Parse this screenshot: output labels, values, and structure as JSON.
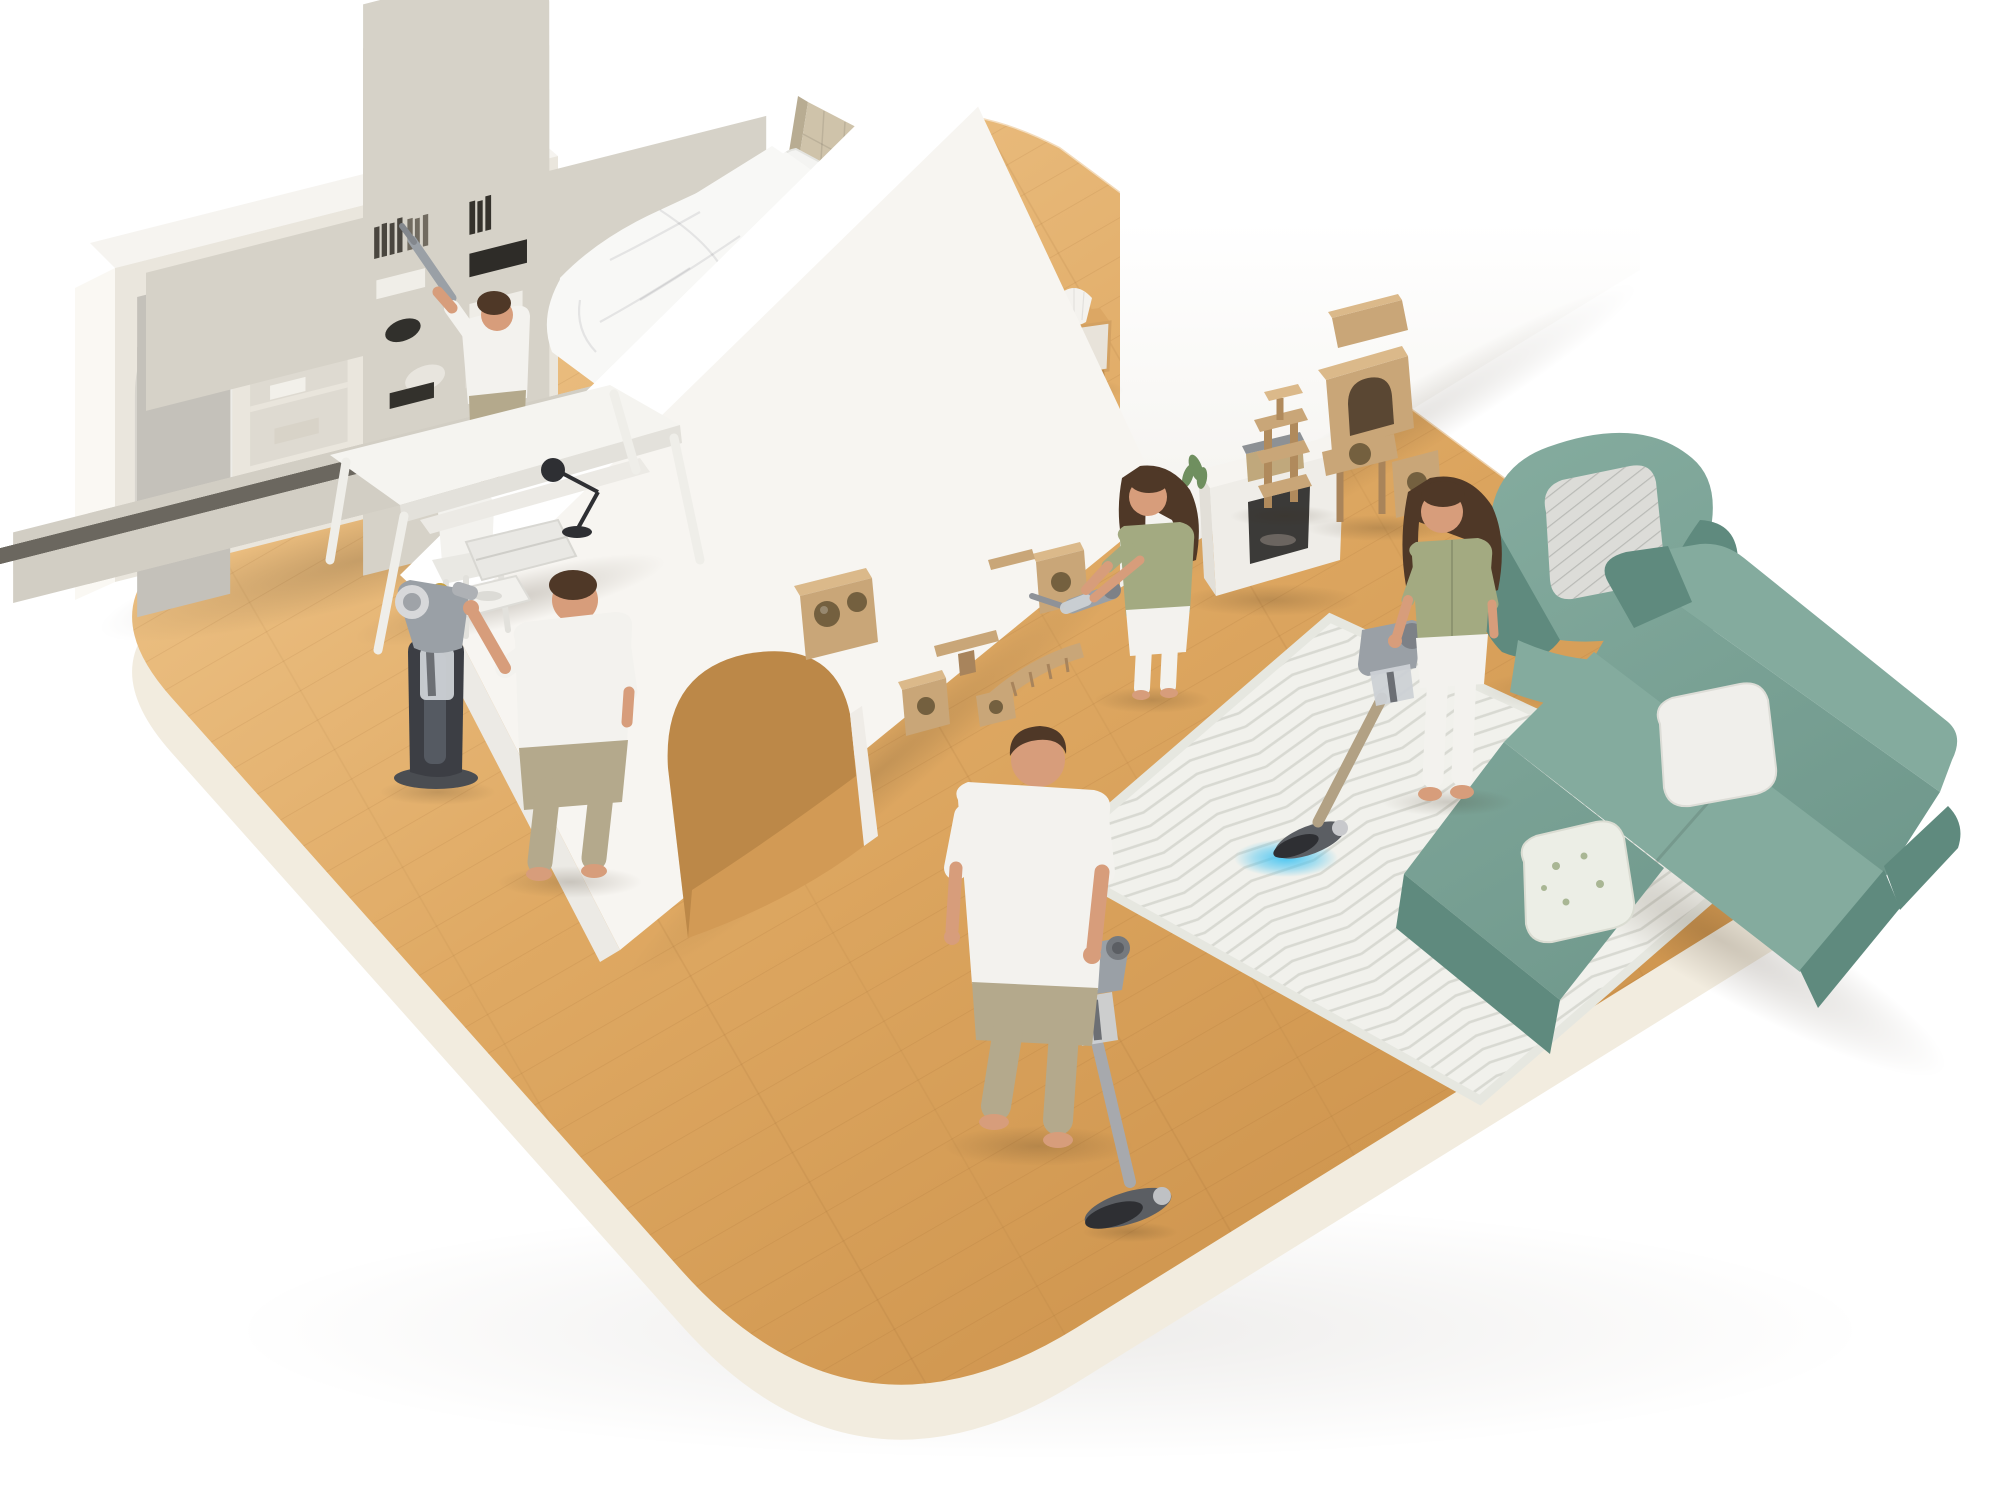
{
  "meta": {
    "description": "Isometric cutaway 3D illustration of a bright home on a rounded wooden floor platform; six people clean different areas with cordless stick and handheld vacuums",
    "canvas": {
      "width": 2000,
      "height": 1500
    }
  },
  "palette": {
    "wood": "#dfa963",
    "wood_light": "#eec489",
    "wood_dark": "#cd934c",
    "platform_side": "#f2ecdf",
    "platform_side2": "#faf8f3",
    "wall_white": "#f7f5f1",
    "wall_top": "#ffffff",
    "wall_end": "#eceae5",
    "cream": "#eae6dd",
    "shelf_inner": "#dedad1",
    "glass": "#d7d4cd",
    "headboard": "#cfc3aa",
    "bed_base": "#ccc1a8",
    "bedding": "#f8f8f6",
    "pillow": "#f4f4f2",
    "skin": "#d79d7b",
    "hair": "#4f3827",
    "green_top": "#a3aa81",
    "white_cloth": "#f3f2ee",
    "khaki": "#b4a98c",
    "vacuum_gray": "#9aa0a6",
    "vacuum_dark": "#5b5e63",
    "vacuum_bin": "#ccd1d5",
    "wand_gold": "#b2a184",
    "glow_blue": "#45c4f2",
    "cat_wood": "#c9a678",
    "cat_wood_dark": "#a8845c",
    "cat_wood_top": "#dbb98a",
    "cat_hole": "#74603f",
    "teal": "#78a295",
    "teal_dark": "#5f8a7e",
    "teal_light": "#84ab9e",
    "rug": "#f1f1ec",
    "rug_stripe": "#d8d9d2",
    "dock": "#3c3e44",
    "dock_light": "#555a62",
    "lamp_white": "#f4f2ee",
    "plant_green": "#6f8f5f",
    "storage_box": "#c0a87c",
    "storage_lid": "#8d9195",
    "firebox": "#3b3a38"
  },
  "scene": {
    "setting": "Open-plan apartment diorama: bedroom and study on the left, living room with cat wall on the right, separated by a white partition wall with an arched doorway",
    "rooms": [
      {
        "id": "bedroom",
        "name": "Bedroom",
        "furniture": [
          "bed with beige tufted headboard",
          "white rumpled duvet and pillows",
          "wooden nightstand with pleated lamp and photo frame"
        ]
      },
      {
        "id": "study",
        "name": "Study corner",
        "furniture": [
          "cream wall bookshelf with arched glass cabinet",
          "white desk with laptop, desk lamp, tray",
          "white chair",
          "vacuum charging dock"
        ]
      },
      {
        "id": "living-room",
        "name": "Living room",
        "furniture": [
          "white fireplace mantel with storage box and plant",
          "two beige cat towers",
          "wall-mounted cat climbing cubes, shelves and bridge",
          "teal armchair with striped pillow",
          "teal sectional sofa with pillows",
          "white chevron area rug"
        ]
      }
    ],
    "people": [
      {
        "id": "bookshelf-man",
        "activity": "Man dusting high bookshelf shelf with slim vacuum tool",
        "top": "white tee",
        "bottom": "beige pants"
      },
      {
        "id": "bed-woman",
        "activity": "Woman sitting on bed vacuuming mattress with handheld vacuum, blue light on",
        "top": "sage green shirt",
        "bottom": "white pants"
      },
      {
        "id": "dock-man",
        "activity": "Man docking handheld vacuum on charging stand beside desk",
        "top": "white tee",
        "bottom": "khaki pants"
      },
      {
        "id": "cat-wall-woman",
        "activity": "Woman vacuuming wall-mounted cat shelves with handheld vacuum",
        "top": "sage green shirt",
        "bottom": "white skirt"
      },
      {
        "id": "carpet-woman",
        "activity": "Woman vacuuming chevron rug with stick vacuum, blue light on carpet",
        "top": "sage green cardigan",
        "bottom": "white jeans"
      },
      {
        "id": "foreground-man",
        "activity": "Man vacuuming wooden floor with long stick vacuum in foreground",
        "top": "white tee",
        "bottom": "khaki pants"
      }
    ],
    "appliances": [
      {
        "id": "stick-vacuum-floor",
        "state": "in use on hardwood"
      },
      {
        "id": "stick-vacuum-carpet",
        "state": "in use on rug, blue illumination"
      },
      {
        "id": "handheld-vacuum-bed",
        "state": "in use on mattress, blue illumination"
      },
      {
        "id": "handheld-vacuum-cat-wall",
        "state": "in use on cat shelves"
      },
      {
        "id": "slim-tool-bookshelf",
        "state": "in use on shelf"
      },
      {
        "id": "charging-dock",
        "state": "holding handheld unit"
      }
    ]
  }
}
